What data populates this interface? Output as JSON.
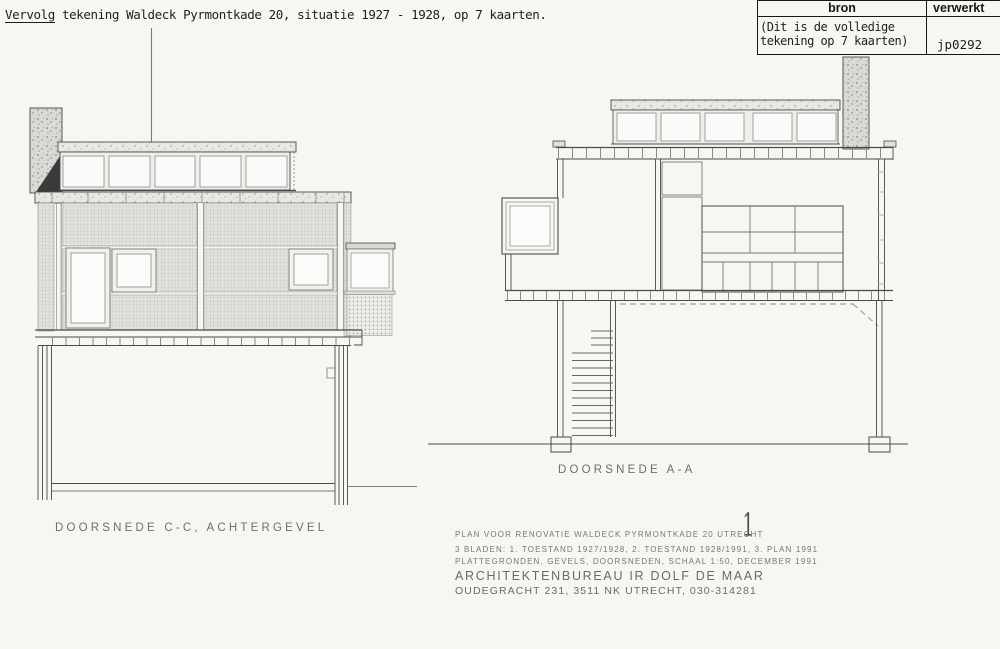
{
  "colors": {
    "paper": "#f7f6f3",
    "ink": "#4a4a4a",
    "frame": "#161616"
  },
  "header": {
    "underlined_word": "Vervolg",
    "text": " tekening Waldeck Pyrmontkade 20, situatie 1927 - 1928, op 7 kaarten."
  },
  "source_table": {
    "bron_header": "bron",
    "verwerkt_header": "verwerkt",
    "note_line1": "(Dit is de volledige",
    "note_line2": "tekening op 7 kaarten)",
    "code": "jp0292"
  },
  "drawings": {
    "left_label": "DOORSNEDE C-C, ACHTERGEVEL",
    "right_label": "DOORSNEDE A-A",
    "sheet_mark": "1"
  },
  "title_block": {
    "line1": "PLAN VOOR RENOVATIE WALDECK PYRMONTKADE 20 UTRECHT",
    "line2": "3 BLADEN: 1. TOESTAND 1927/1928, 2. TOESTAND 1928/1991, 3. PLAN 1991",
    "line3": "PLATTEGRONDEN, GEVELS, DOORSNEDEN, SCHAAL 1:50, DECEMBER 1991",
    "firm": "ARCHITEKTENBUREAU IR DOLF DE MAAR",
    "address": "OUDEGRACHT 231, 3511 NK UTRECHT, 030-314281"
  }
}
